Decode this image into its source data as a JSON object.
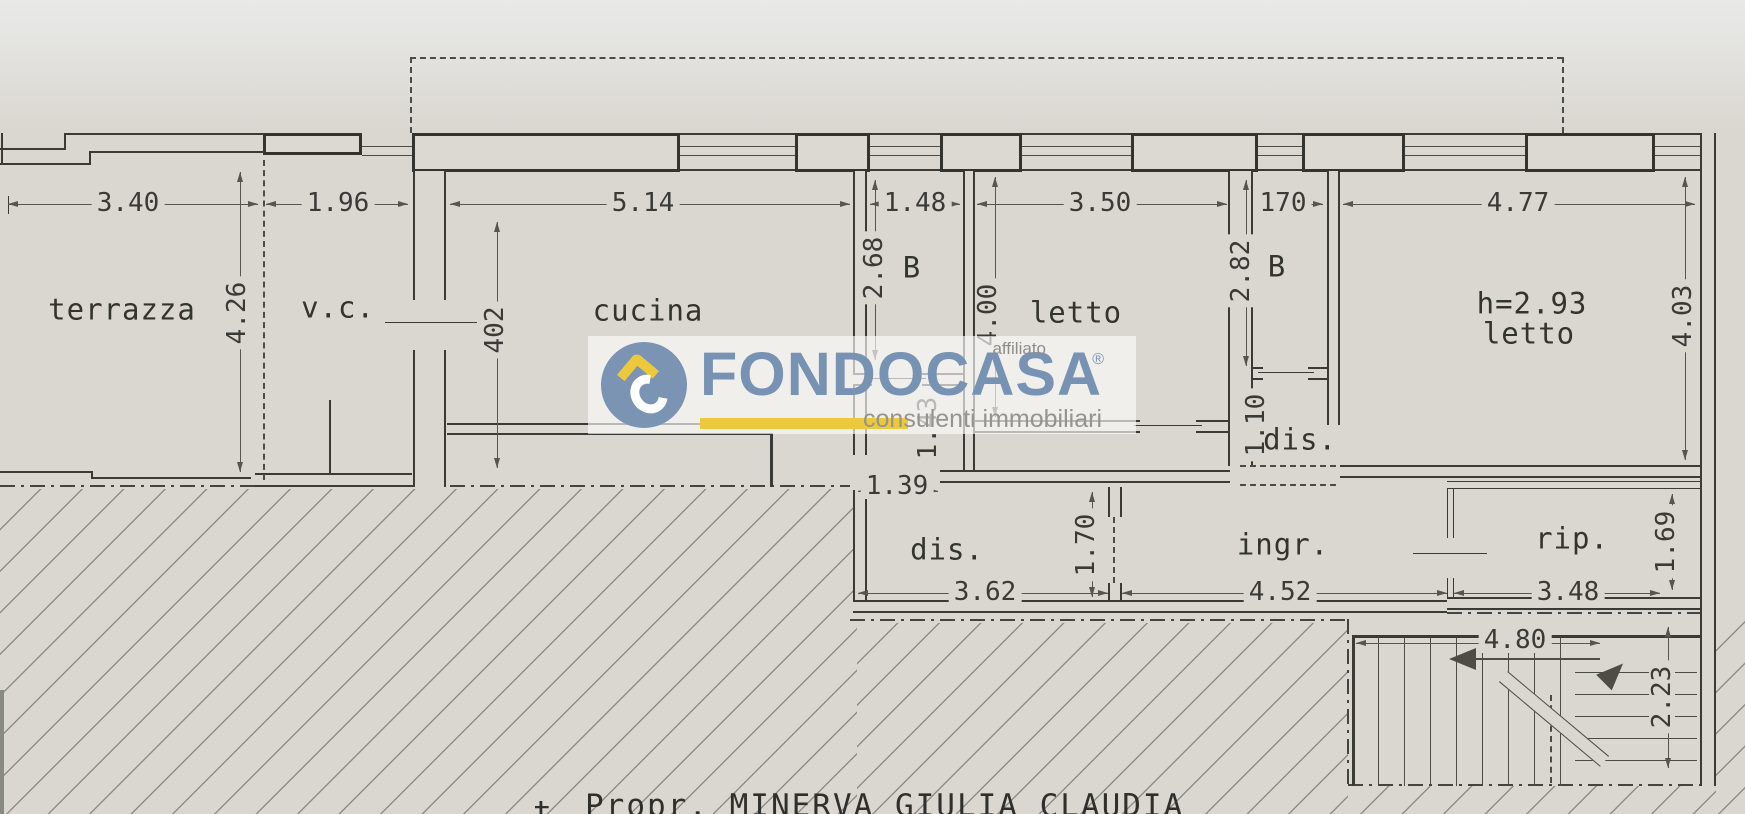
{
  "plan": {
    "rooms": {
      "terrazza": "terrazza",
      "vc": "v.c.",
      "cucina": "cucina",
      "b1": "B",
      "letto1": "letto",
      "b2": "B",
      "dis2": "dis.",
      "letto2_height": "h=2.93",
      "letto2": "letto",
      "dis1": "dis.",
      "ingr": "ingr.",
      "rip": "rip."
    },
    "dims": {
      "terrazza_w": "3.40",
      "vc_w": "1.96",
      "cucina_w": "5.14",
      "b1_w": "1.48",
      "letto1_w": "3.50",
      "corr_w": "170",
      "letto2_w": "4.77",
      "terrazza_h": "4.26",
      "cucina_h": "402",
      "b1_h": "2.68",
      "letto1_h": "4.00",
      "b2_h": "2.82",
      "letto2_h": "4.03",
      "pass_h": "1.43",
      "pass_w": "1.39",
      "dis2_h": "1.10",
      "opening_h": "1.70",
      "dis1_w": "3.62",
      "ingr_w": "4.52",
      "rip_w": "3.48",
      "rip_h": "1.69",
      "stairs_w": "4.80",
      "stairs_h": "2.23"
    }
  },
  "watermark": {
    "brand": "FONDOCASA",
    "affiliate": "affiliato",
    "registered": "®",
    "tagline": "consulenti immobiliari"
  },
  "footer": {
    "fragment": "t",
    "owner": "Propr. MINERVA GIULIA CLAUDIA"
  },
  "colors": {
    "paper": "#dad7d1",
    "line": "#3a3a36",
    "logo_blue": "#7892b3",
    "logo_yellow": "#ecc83d"
  }
}
